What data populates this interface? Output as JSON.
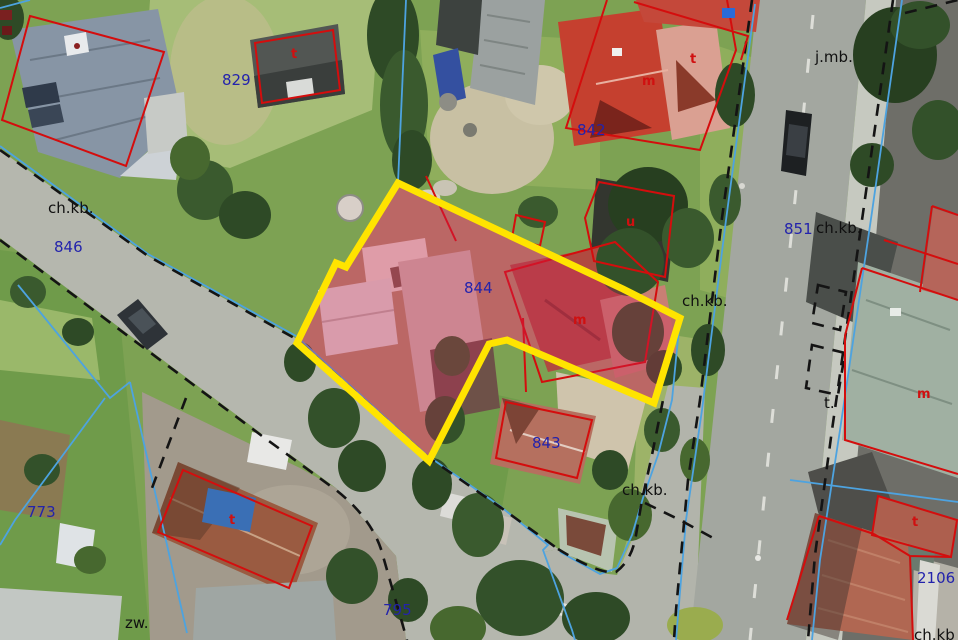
{
  "map": {
    "description": "Aerial orthophoto with cadastral parcel overlay, parcel 844 selected",
    "selected_parcel": {
      "number": "844",
      "outline_color": "#ffe400",
      "highlight_fill": "rgba(206,33,90,0.33)"
    },
    "colors": {
      "parcel_number_text": "#2323ac",
      "landuse_text": "#101010",
      "building_letter_text": "#d01010",
      "boundary_red": "#d40d0d",
      "boundary_blue": "#4da3e0",
      "boundary_black": "#141414"
    },
    "parcel_numbers": [
      {
        "id": "829",
        "text": "829",
        "x": 222,
        "y": 73
      },
      {
        "id": "846",
        "text": "846",
        "x": 54,
        "y": 240
      },
      {
        "id": "842",
        "text": "842",
        "x": 577,
        "y": 123
      },
      {
        "id": "844",
        "text": "844",
        "x": 464,
        "y": 281
      },
      {
        "id": "843",
        "text": "843",
        "x": 532,
        "y": 436
      },
      {
        "id": "851",
        "text": "851",
        "x": 784,
        "y": 222
      },
      {
        "id": "773",
        "text": "773",
        "x": 27,
        "y": 505
      },
      {
        "id": "795",
        "text": "795",
        "x": 383,
        "y": 603
      },
      {
        "id": "2106",
        "text": "2106",
        "x": 917,
        "y": 571
      }
    ],
    "landuse_labels": [
      {
        "id": "chkb-topleft",
        "text": "ch.kb.",
        "x": 48,
        "y": 201
      },
      {
        "id": "jmb",
        "text": "j.mb.",
        "x": 815,
        "y": 50
      },
      {
        "id": "chkb-road",
        "text": "ch.kb.",
        "x": 816,
        "y": 221
      },
      {
        "id": "chkb-mid",
        "text": "ch.kb.",
        "x": 682,
        "y": 294
      },
      {
        "id": "chkb-bottom",
        "text": "ch.kb.",
        "x": 622,
        "y": 483
      },
      {
        "id": "chkb-corner",
        "text": "ch.kb",
        "x": 914,
        "y": 628
      },
      {
        "id": "zw",
        "text": "zw.",
        "x": 125,
        "y": 616
      },
      {
        "id": "t-dot",
        "text": "t.",
        "x": 824,
        "y": 396
      }
    ],
    "building_letters": [
      {
        "id": "m-842",
        "text": "m",
        "x": 642,
        "y": 75
      },
      {
        "id": "m-844",
        "text": "m",
        "x": 573,
        "y": 314
      },
      {
        "id": "m-right",
        "text": "m",
        "x": 917,
        "y": 388
      },
      {
        "id": "t-right",
        "text": "t",
        "x": 912,
        "y": 516
      },
      {
        "id": "t-shed",
        "text": "t",
        "x": 291,
        "y": 48
      },
      {
        "id": "u-shed",
        "text": "u",
        "x": 626,
        "y": 216
      },
      {
        "id": "t-773",
        "text": "t",
        "x": 229,
        "y": 514
      },
      {
        "id": "t-topright",
        "text": "t",
        "x": 690,
        "y": 53
      }
    ]
  }
}
